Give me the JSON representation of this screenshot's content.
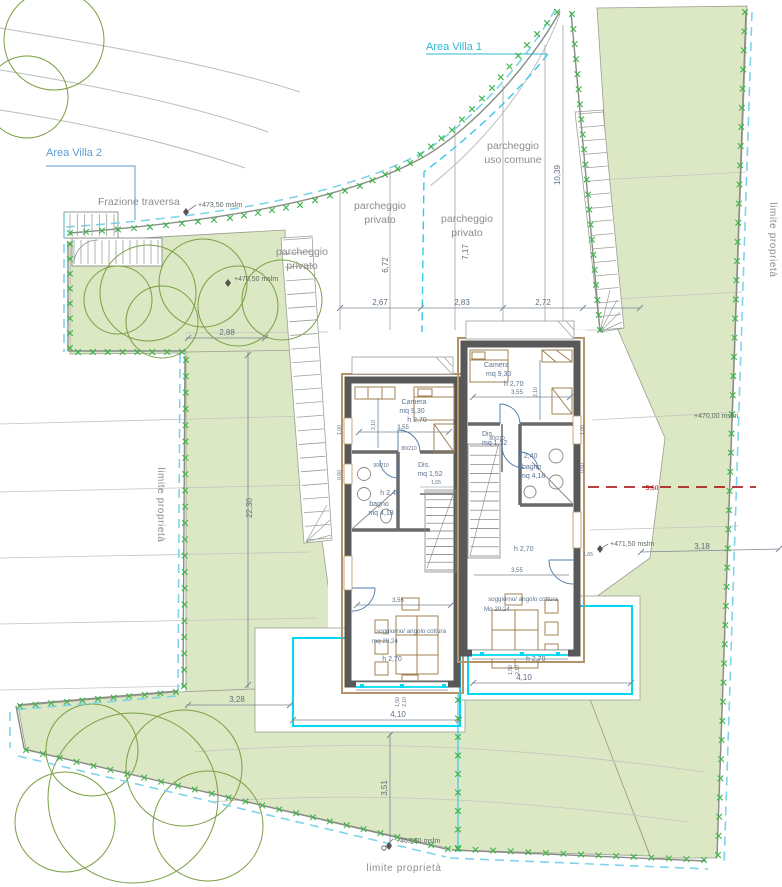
{
  "plan": {
    "areas": {
      "villa1": "Area Villa 1",
      "villa2": "Area Villa 2"
    },
    "street": "Frazione traversa",
    "boundary_label": "limite proprietà",
    "parking_common": [
      "parcheggio",
      "uso comune"
    ],
    "parking_private": [
      "parcheggio",
      "privato"
    ],
    "elevations": {
      "e473_50": "+473,50 mslm",
      "e470_50": "+470,50 mslm",
      "e470_00": "+470,00 mslm",
      "e471_50": "+471,50 mslm",
      "e463_50": "+463,50 mslm"
    },
    "dims": {
      "w2_88": "2,88",
      "w2_67": "2,67",
      "w2_83": "2,83",
      "w2_72": "2,72",
      "v6_72": "6,72",
      "v7_17": "7,17",
      "v10_39": "10,39",
      "v22_30": "22,30",
      "w3_28": "3,28",
      "w4_10": "4,10",
      "v3_51": "3,51",
      "w3_18": "3,18",
      "r5_60": "5,60",
      "w3_55": "3,55",
      "w1_65": "1,65",
      "d80_210": "80/210",
      "d90_210": "90/210",
      "v1_50": "1,50",
      "v2_10": "2,10",
      "v1_00": "1,00",
      "v0_60": "0,60"
    },
    "rooms": {
      "left": {
        "camera": "Camera",
        "camera_mq": "mq 9,30",
        "camera_h": "h 2,70",
        "dis": "Dis.",
        "dis_mq": "mq 1,52",
        "bath_h": "h 2,40",
        "bagno": "bagno",
        "bagno_mq": "mq 4,18",
        "sogg": "soggiorno/ angolo cottura",
        "sogg_mq": "mq 20,24",
        "sogg_h": "h 2,70"
      },
      "right": {
        "camera": "Camera",
        "camera_mq": "mq 9,30",
        "camera_h": "h 2,70",
        "dis": "Dis.",
        "dis_mq": "mq 1,52",
        "bath_h": "h 2,40",
        "bagno": "bagno",
        "bagno_mq": "mq 4,18",
        "floor_h": "h 2,70",
        "sogg": "soggiorno/ angolo cottura",
        "sogg_mq": "Mq 20,24",
        "terrace_h": "h 2,70"
      }
    },
    "colors": {
      "parcel_green": "#dce7c4",
      "boundary_mark": "#3cb44a",
      "boundary_dash": "#7fd4ea",
      "divider_cyan": "#35c8e8",
      "pool_cyan": "#00d9f2",
      "wall_gray": "#585858",
      "trim_tan": "#b5946a",
      "accent_blue": "#5b9bd5",
      "label_cyan": "#2fb9d4",
      "dim_red": "#a00000"
    }
  }
}
